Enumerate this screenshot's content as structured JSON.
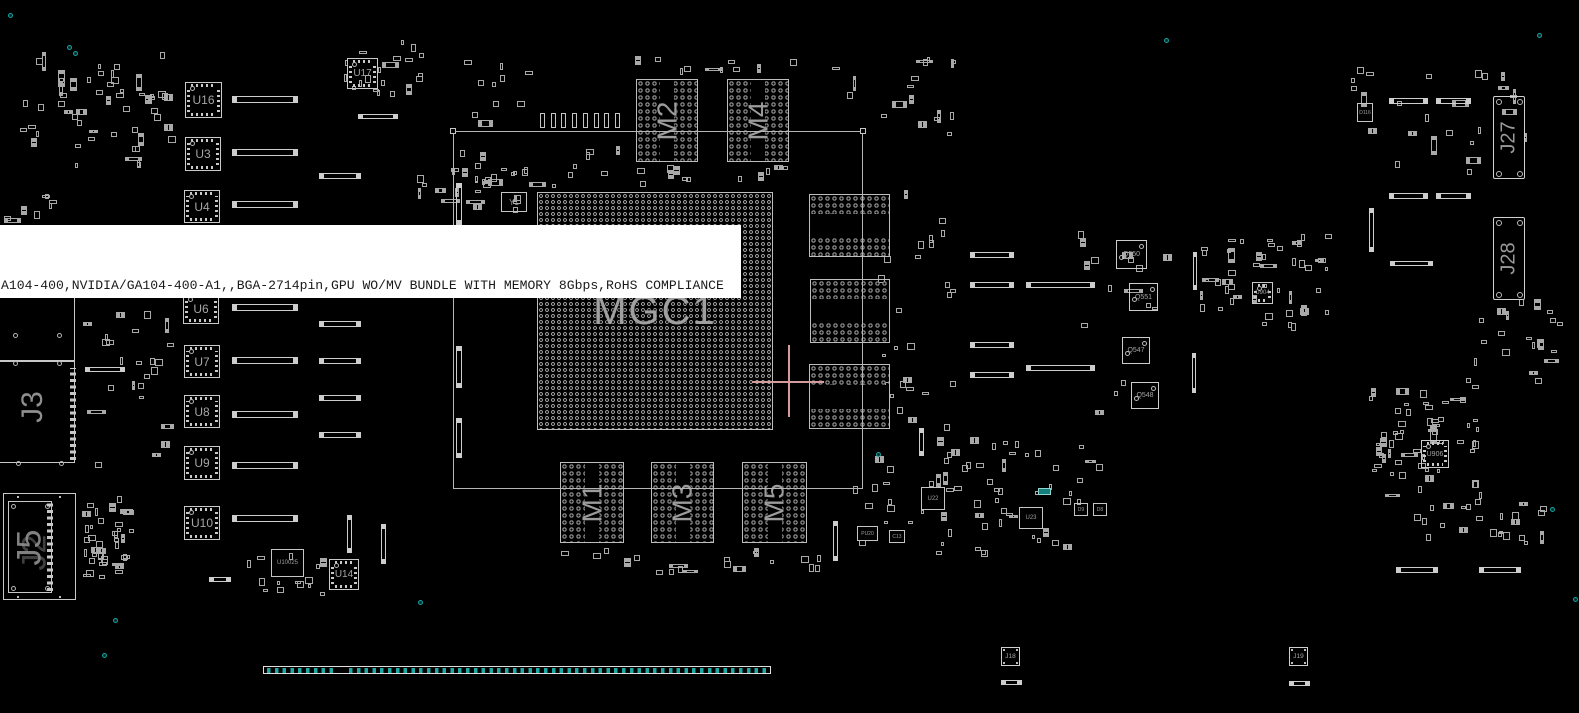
{
  "tooltip": {
    "text": "A104-400,NVIDIA/GA104-400-A1,,BGA-2714pin,GPU WO/MV BUNDLE WITH MEMORY 8Gbps,RoHS COMPLIANCE",
    "bg": "#ffffff",
    "fg": "#1a1a1a"
  },
  "colors": {
    "background": "#000000",
    "outline": "#c9c9c9",
    "silkscreen_label": "#9c9c9c",
    "teal": "#17a2a0",
    "edge_pad_teal": "#1fa7a3",
    "crosshair": "#d49c9c",
    "tooltip_bg": "#ffffff",
    "tooltip_fg": "#1a1a1a"
  },
  "board": {
    "gpu_box": {
      "x": 453,
      "y": 131,
      "w": 410,
      "h": 358
    },
    "corner_squares": [
      [
        450,
        128
      ],
      [
        860,
        128
      ]
    ],
    "main_chip": {
      "label": "MGC1",
      "x": 537,
      "y": 192,
      "w": 236,
      "h": 238
    },
    "memories": [
      {
        "label": "M2",
        "x": 636,
        "y": 79,
        "w": 62,
        "h": 83,
        "orient": "v"
      },
      {
        "label": "M4",
        "x": 727,
        "y": 79,
        "w": 62,
        "h": 83,
        "orient": "v"
      },
      {
        "label": "M6",
        "x": 809,
        "y": 194,
        "w": 81,
        "h": 63,
        "orient": "h"
      },
      {
        "label": "M7",
        "x": 810,
        "y": 279,
        "w": 80,
        "h": 64,
        "orient": "h"
      },
      {
        "label": "M8",
        "x": 809,
        "y": 364,
        "w": 81,
        "h": 65,
        "orient": "h"
      },
      {
        "label": "M1",
        "x": 560,
        "y": 462,
        "w": 64,
        "h": 81,
        "orient": "v"
      },
      {
        "label": "M3",
        "x": 651,
        "y": 462,
        "w": 63,
        "h": 81,
        "orient": "v"
      },
      {
        "label": "M5",
        "x": 742,
        "y": 462,
        "w": 65,
        "h": 81,
        "orient": "v"
      }
    ],
    "ics": [
      {
        "label": "U16",
        "x": 185,
        "y": 82,
        "w": 37,
        "h": 36,
        "fs": 12
      },
      {
        "label": "U3",
        "x": 185,
        "y": 137,
        "w": 36,
        "h": 34,
        "fs": 12
      },
      {
        "label": "U4",
        "x": 184,
        "y": 190,
        "w": 36,
        "h": 33,
        "fs": 12
      },
      {
        "label": "U6",
        "x": 183,
        "y": 293,
        "w": 36,
        "h": 31,
        "fs": 12
      },
      {
        "label": "U7",
        "x": 184,
        "y": 345,
        "w": 36,
        "h": 33,
        "fs": 12
      },
      {
        "label": "U8",
        "x": 184,
        "y": 395,
        "w": 36,
        "h": 33,
        "fs": 12
      },
      {
        "label": "U9",
        "x": 184,
        "y": 446,
        "w": 36,
        "h": 34,
        "fs": 12
      },
      {
        "label": "U10",
        "x": 184,
        "y": 506,
        "w": 36,
        "h": 34,
        "fs": 12
      },
      {
        "label": "U17",
        "x": 347,
        "y": 58,
        "w": 31,
        "h": 31,
        "fs": 10
      },
      {
        "label": "U14",
        "x": 329,
        "y": 559,
        "w": 30,
        "h": 31,
        "fs": 10
      },
      {
        "label": "U904",
        "x": 1252,
        "y": 282,
        "w": 21,
        "h": 22,
        "fs": 6
      },
      {
        "label": "U906",
        "x": 1421,
        "y": 440,
        "w": 28,
        "h": 28,
        "fs": 7
      }
    ],
    "small_chips": [
      {
        "label": "Y1",
        "x": 501,
        "y": 192,
        "w": 26,
        "h": 20,
        "fs": 8
      },
      {
        "label": "U10025",
        "x": 271,
        "y": 549,
        "w": 33,
        "h": 28,
        "fs": 6
      },
      {
        "label": "PU20",
        "x": 857,
        "y": 526,
        "w": 21,
        "h": 15,
        "fs": 5
      },
      {
        "label": "C13",
        "x": 889,
        "y": 530,
        "w": 16,
        "h": 13,
        "fs": 5
      },
      {
        "label": "U22",
        "x": 921,
        "y": 487,
        "w": 24,
        "h": 23,
        "fs": 6
      },
      {
        "label": "U23",
        "x": 1019,
        "y": 507,
        "w": 24,
        "h": 22,
        "fs": 6
      },
      {
        "label": "D9",
        "x": 1074,
        "y": 503,
        "w": 14,
        "h": 13,
        "fs": 5
      },
      {
        "label": "D8",
        "x": 1093,
        "y": 503,
        "w": 14,
        "h": 13,
        "fs": 5
      },
      {
        "label": "D116",
        "x": 1357,
        "y": 103,
        "w": 16,
        "h": 19,
        "fs": 5
      }
    ],
    "q_chips": [
      {
        "label": "Q550",
        "x": 1116,
        "y": 240,
        "w": 31,
        "h": 29,
        "fs": 7
      },
      {
        "label": "Q551",
        "x": 1129,
        "y": 283,
        "w": 29,
        "h": 28,
        "fs": 7
      },
      {
        "label": "Q547",
        "x": 1122,
        "y": 337,
        "w": 28,
        "h": 27,
        "fs": 7
      },
      {
        "label": "Q548",
        "x": 1131,
        "y": 382,
        "w": 28,
        "h": 27,
        "fs": 7
      }
    ],
    "connectors": {
      "j3": {
        "label": "J3",
        "rect1": [
          -20,
          293,
          95,
          68
        ],
        "rect2": [
          -20,
          361,
          95,
          102
        ],
        "pincol": [
          70,
          368,
          6,
          92
        ],
        "circles": [
          [
            13,
            333
          ],
          [
            57,
            333
          ],
          [
            13,
            361
          ],
          [
            57,
            361
          ],
          [
            16,
            461
          ],
          [
            59,
            461
          ]
        ],
        "label_pos": [
          18,
          385
        ]
      },
      "j5": {
        "label": "J5",
        "label2": "J2",
        "outer": [
          3,
          493,
          73,
          107
        ],
        "inner": [
          8,
          501,
          44,
          92
        ],
        "pincol": [
          47,
          503,
          6,
          88
        ],
        "inner_circles": [
          [
            2,
            2
          ],
          [
            36,
            2
          ],
          [
            2,
            84
          ],
          [
            36,
            84
          ]
        ],
        "outer_dots": [
          [
            13,
            2
          ],
          [
            55,
            2
          ],
          [
            13,
            102
          ],
          [
            55,
            102
          ]
        ]
      },
      "j27": {
        "label": "J27",
        "x": 1493,
        "y": 96,
        "w": 32,
        "h": 83
      },
      "j28": {
        "label": "J28",
        "x": 1493,
        "y": 217,
        "w": 32,
        "h": 83
      },
      "j18": {
        "label": "J18",
        "x": 1001,
        "y": 647,
        "w": 19,
        "h": 19,
        "bar": [
          1001,
          680,
          21,
          5
        ]
      },
      "j19": {
        "label": "J19",
        "x": 1289,
        "y": 647,
        "w": 19,
        "h": 19,
        "bar": [
          1289,
          681,
          21,
          5
        ]
      },
      "edge": {
        "x": 263,
        "y": 666,
        "w": 508,
        "h": 8,
        "strips": [
          [
            3,
            69
          ],
          [
            85,
            417
          ]
        ]
      }
    },
    "hbars": [
      [
        232,
        96,
        66,
        7
      ],
      [
        232,
        149,
        66,
        7
      ],
      [
        232,
        201,
        66,
        7
      ],
      [
        232,
        304,
        66,
        7
      ],
      [
        232,
        357,
        66,
        7
      ],
      [
        232,
        411,
        66,
        7
      ],
      [
        232,
        462,
        66,
        7
      ],
      [
        232,
        515,
        66,
        7
      ],
      [
        319,
        321,
        42,
        6
      ],
      [
        319,
        358,
        42,
        6
      ],
      [
        319,
        395,
        42,
        6
      ],
      [
        319,
        432,
        42,
        6
      ],
      [
        358,
        114,
        40,
        5
      ],
      [
        319,
        173,
        42,
        6
      ],
      [
        1389,
        98,
        39,
        6
      ],
      [
        1436,
        98,
        35,
        6
      ],
      [
        1389,
        193,
        39,
        6
      ],
      [
        1436,
        193,
        35,
        6
      ],
      [
        970,
        252,
        44,
        6
      ],
      [
        970,
        282,
        44,
        6
      ],
      [
        1026,
        282,
        69,
        6
      ],
      [
        970,
        342,
        44,
        6
      ],
      [
        1026,
        365,
        69,
        6
      ],
      [
        970,
        372,
        44,
        6
      ],
      [
        1396,
        567,
        42,
        6
      ],
      [
        1479,
        567,
        42,
        6
      ],
      [
        85,
        367,
        40,
        5
      ],
      [
        1390,
        261,
        43,
        5
      ],
      [
        209,
        577,
        22,
        5
      ]
    ],
    "vbars": [
      [
        456,
        183,
        6,
        42
      ],
      [
        456,
        346,
        6,
        42
      ],
      [
        456,
        418,
        6,
        40
      ],
      [
        381,
        524,
        5,
        40
      ],
      [
        347,
        515,
        5,
        38
      ],
      [
        1369,
        208,
        5,
        44
      ],
      [
        1193,
        252,
        4,
        38
      ],
      [
        1192,
        353,
        4,
        40
      ],
      [
        919,
        428,
        5,
        28
      ],
      [
        833,
        521,
        5,
        40
      ]
    ],
    "caps_row": {
      "x": 540,
      "y": 113,
      "count": 8,
      "step": 10.7,
      "w": 5,
      "h": 15
    },
    "teal_dots": [
      [
        8,
        13
      ],
      [
        67,
        45
      ],
      [
        73,
        51
      ],
      [
        1164,
        38
      ],
      [
        1537,
        33
      ],
      [
        876,
        452
      ],
      [
        1550,
        507
      ],
      [
        418,
        600
      ],
      [
        113,
        618
      ],
      [
        102,
        653
      ],
      [
        1573,
        597
      ]
    ],
    "teal_bits": [
      [
        1038,
        488,
        13,
        7
      ]
    ],
    "crosshair": {
      "x": 788,
      "y": 381,
      "arm": 36
    },
    "clusters": [
      [
        20,
        52,
        160,
        125,
        55,
        1
      ],
      [
        80,
        296,
        100,
        175,
        24,
        2
      ],
      [
        78,
        494,
        58,
        50,
        12,
        3
      ],
      [
        83,
        524,
        52,
        62,
        28,
        4
      ],
      [
        413,
        168,
        118,
        48,
        26,
        5
      ],
      [
        460,
        138,
        165,
        55,
        14,
        6
      ],
      [
        598,
        162,
        205,
        26,
        12,
        7
      ],
      [
        868,
        190,
        92,
        250,
        30,
        8
      ],
      [
        548,
        548,
        275,
        28,
        20,
        9
      ],
      [
        853,
        436,
        255,
        122,
        65,
        10
      ],
      [
        1196,
        233,
        138,
        102,
        48,
        11
      ],
      [
        1070,
        228,
        108,
        195,
        16,
        12
      ],
      [
        1368,
        388,
        124,
        124,
        58,
        13
      ],
      [
        1408,
        500,
        150,
        46,
        22,
        14
      ],
      [
        1455,
        62,
        88,
        118,
        12,
        15
      ],
      [
        1318,
        57,
        160,
        120,
        14,
        16
      ],
      [
        240,
        553,
        100,
        48,
        14,
        17
      ],
      [
        455,
        56,
        92,
        72,
        10,
        18
      ],
      [
        628,
        56,
        172,
        20,
        10,
        19
      ],
      [
        793,
        56,
        165,
        82,
        10,
        20
      ],
      [
        900,
        57,
        62,
        82,
        8,
        21
      ],
      [
        0,
        194,
        58,
        30,
        8,
        22
      ],
      [
        1464,
        298,
        100,
        92,
        22,
        23
      ],
      [
        340,
        40,
        92,
        62,
        20,
        24
      ]
    ]
  }
}
